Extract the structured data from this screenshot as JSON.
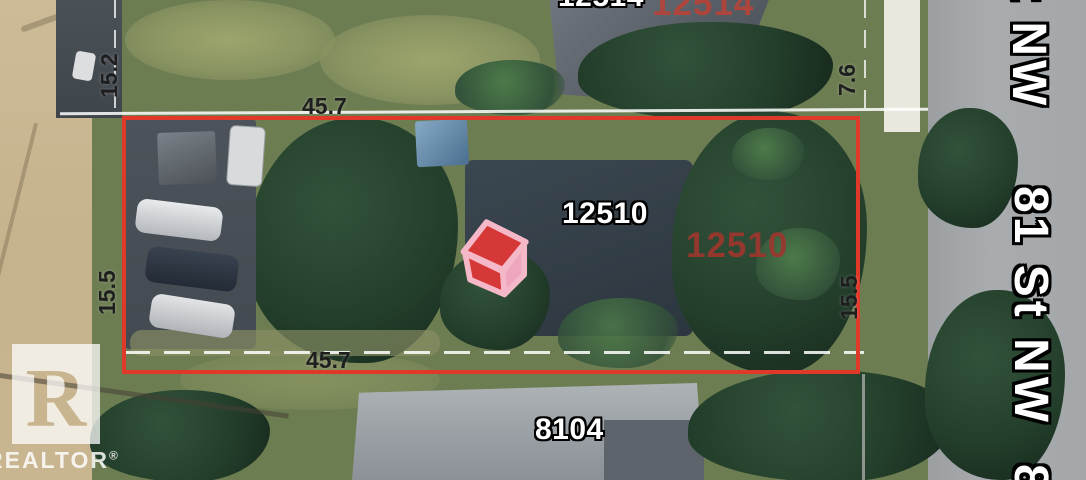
{
  "annotations": {
    "subject_map_label": "12510",
    "subject_listing_label": "12510",
    "north_map_label": "12514",
    "north_listing_label": "12514",
    "south_map_label": "8104"
  },
  "dimensions": {
    "lot_width_top": "45.7",
    "lot_width_bottom": "45.7",
    "lot_depth_left": "15.5",
    "lot_depth_right": "15.5",
    "alley_side": "15.2",
    "upper_right": "7.6"
  },
  "streets": {
    "label_top_partial": "t NW",
    "label_main": "81 St NW",
    "label_bottom_partial": "8"
  },
  "watermark": {
    "logo_letter": "R",
    "brand": "REALTOR",
    "registered_mark": "®"
  },
  "colors": {
    "lot_boundary_red": "#e0392a",
    "listing_label_red": "#9c372e",
    "map_label_white": "#ffffff",
    "dimension_text": "#1e1e1e",
    "marker_roof_red": "#d63838",
    "marker_wall_pink": "#eda6bd"
  }
}
